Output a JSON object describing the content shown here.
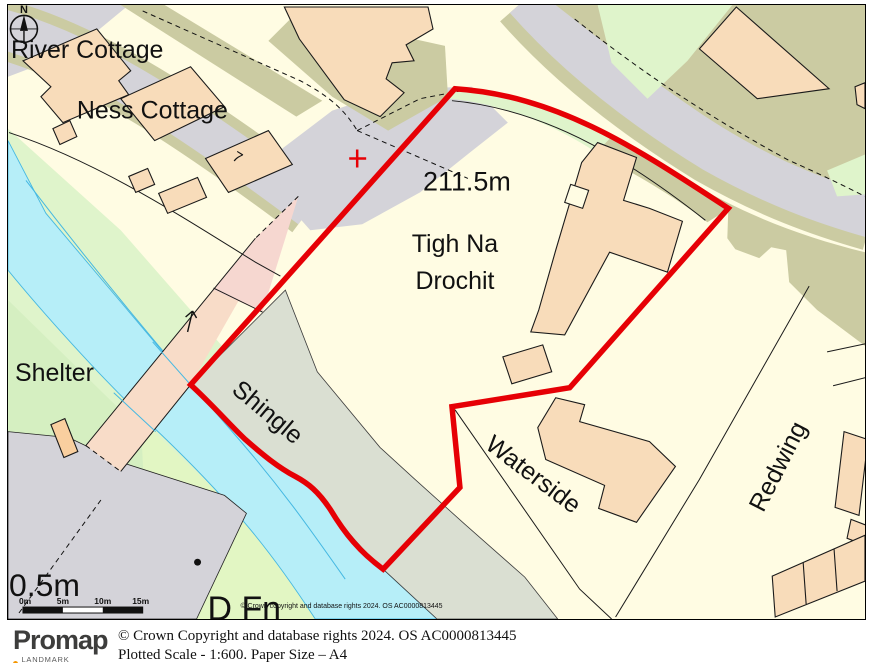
{
  "map": {
    "labels": {
      "river_cottage": "River Cottage",
      "ness_cottage": "Ness Cottage",
      "spot_height": "211.5m",
      "property_line1": "Tigh Na",
      "property_line2": "Drochit",
      "shelter": "Shelter",
      "shingle": "Shingle",
      "waterside": "Waterside",
      "redwing": "Redwing",
      "depth": "0.5m",
      "d_fn": "D Fn",
      "building_mark": "7"
    },
    "compass": {
      "north": "N"
    },
    "scalebar": {
      "labels": [
        "0m",
        "5m",
        "10m",
        "15m"
      ]
    },
    "copyright_small": "© Crown copyright and database rights 2024. OS AC0000813445"
  },
  "footer": {
    "brand": "Promap",
    "brand_sub": "LANDMARK INFORMATION",
    "copyright": "© Crown Copyright and database rights 2024. OS AC0000813445",
    "plot_info": "Plotted Scale - 1:600. Paper Size – A4"
  },
  "colors": {
    "boundary": "#e60005",
    "water": "#b6eef8",
    "road": "#d4d3d9",
    "verge": "#cbcba2",
    "building": "#f8dcba",
    "parcel": "#fffce3",
    "green_light": "#dff4cb",
    "green_mid": "#d5efc1",
    "green_bank": "#e2f6c3",
    "shingle": "#dadfd2",
    "track_pink": "#f6d7d0",
    "bridge": "#f8dcc8",
    "accent_orange": "#f49600"
  }
}
